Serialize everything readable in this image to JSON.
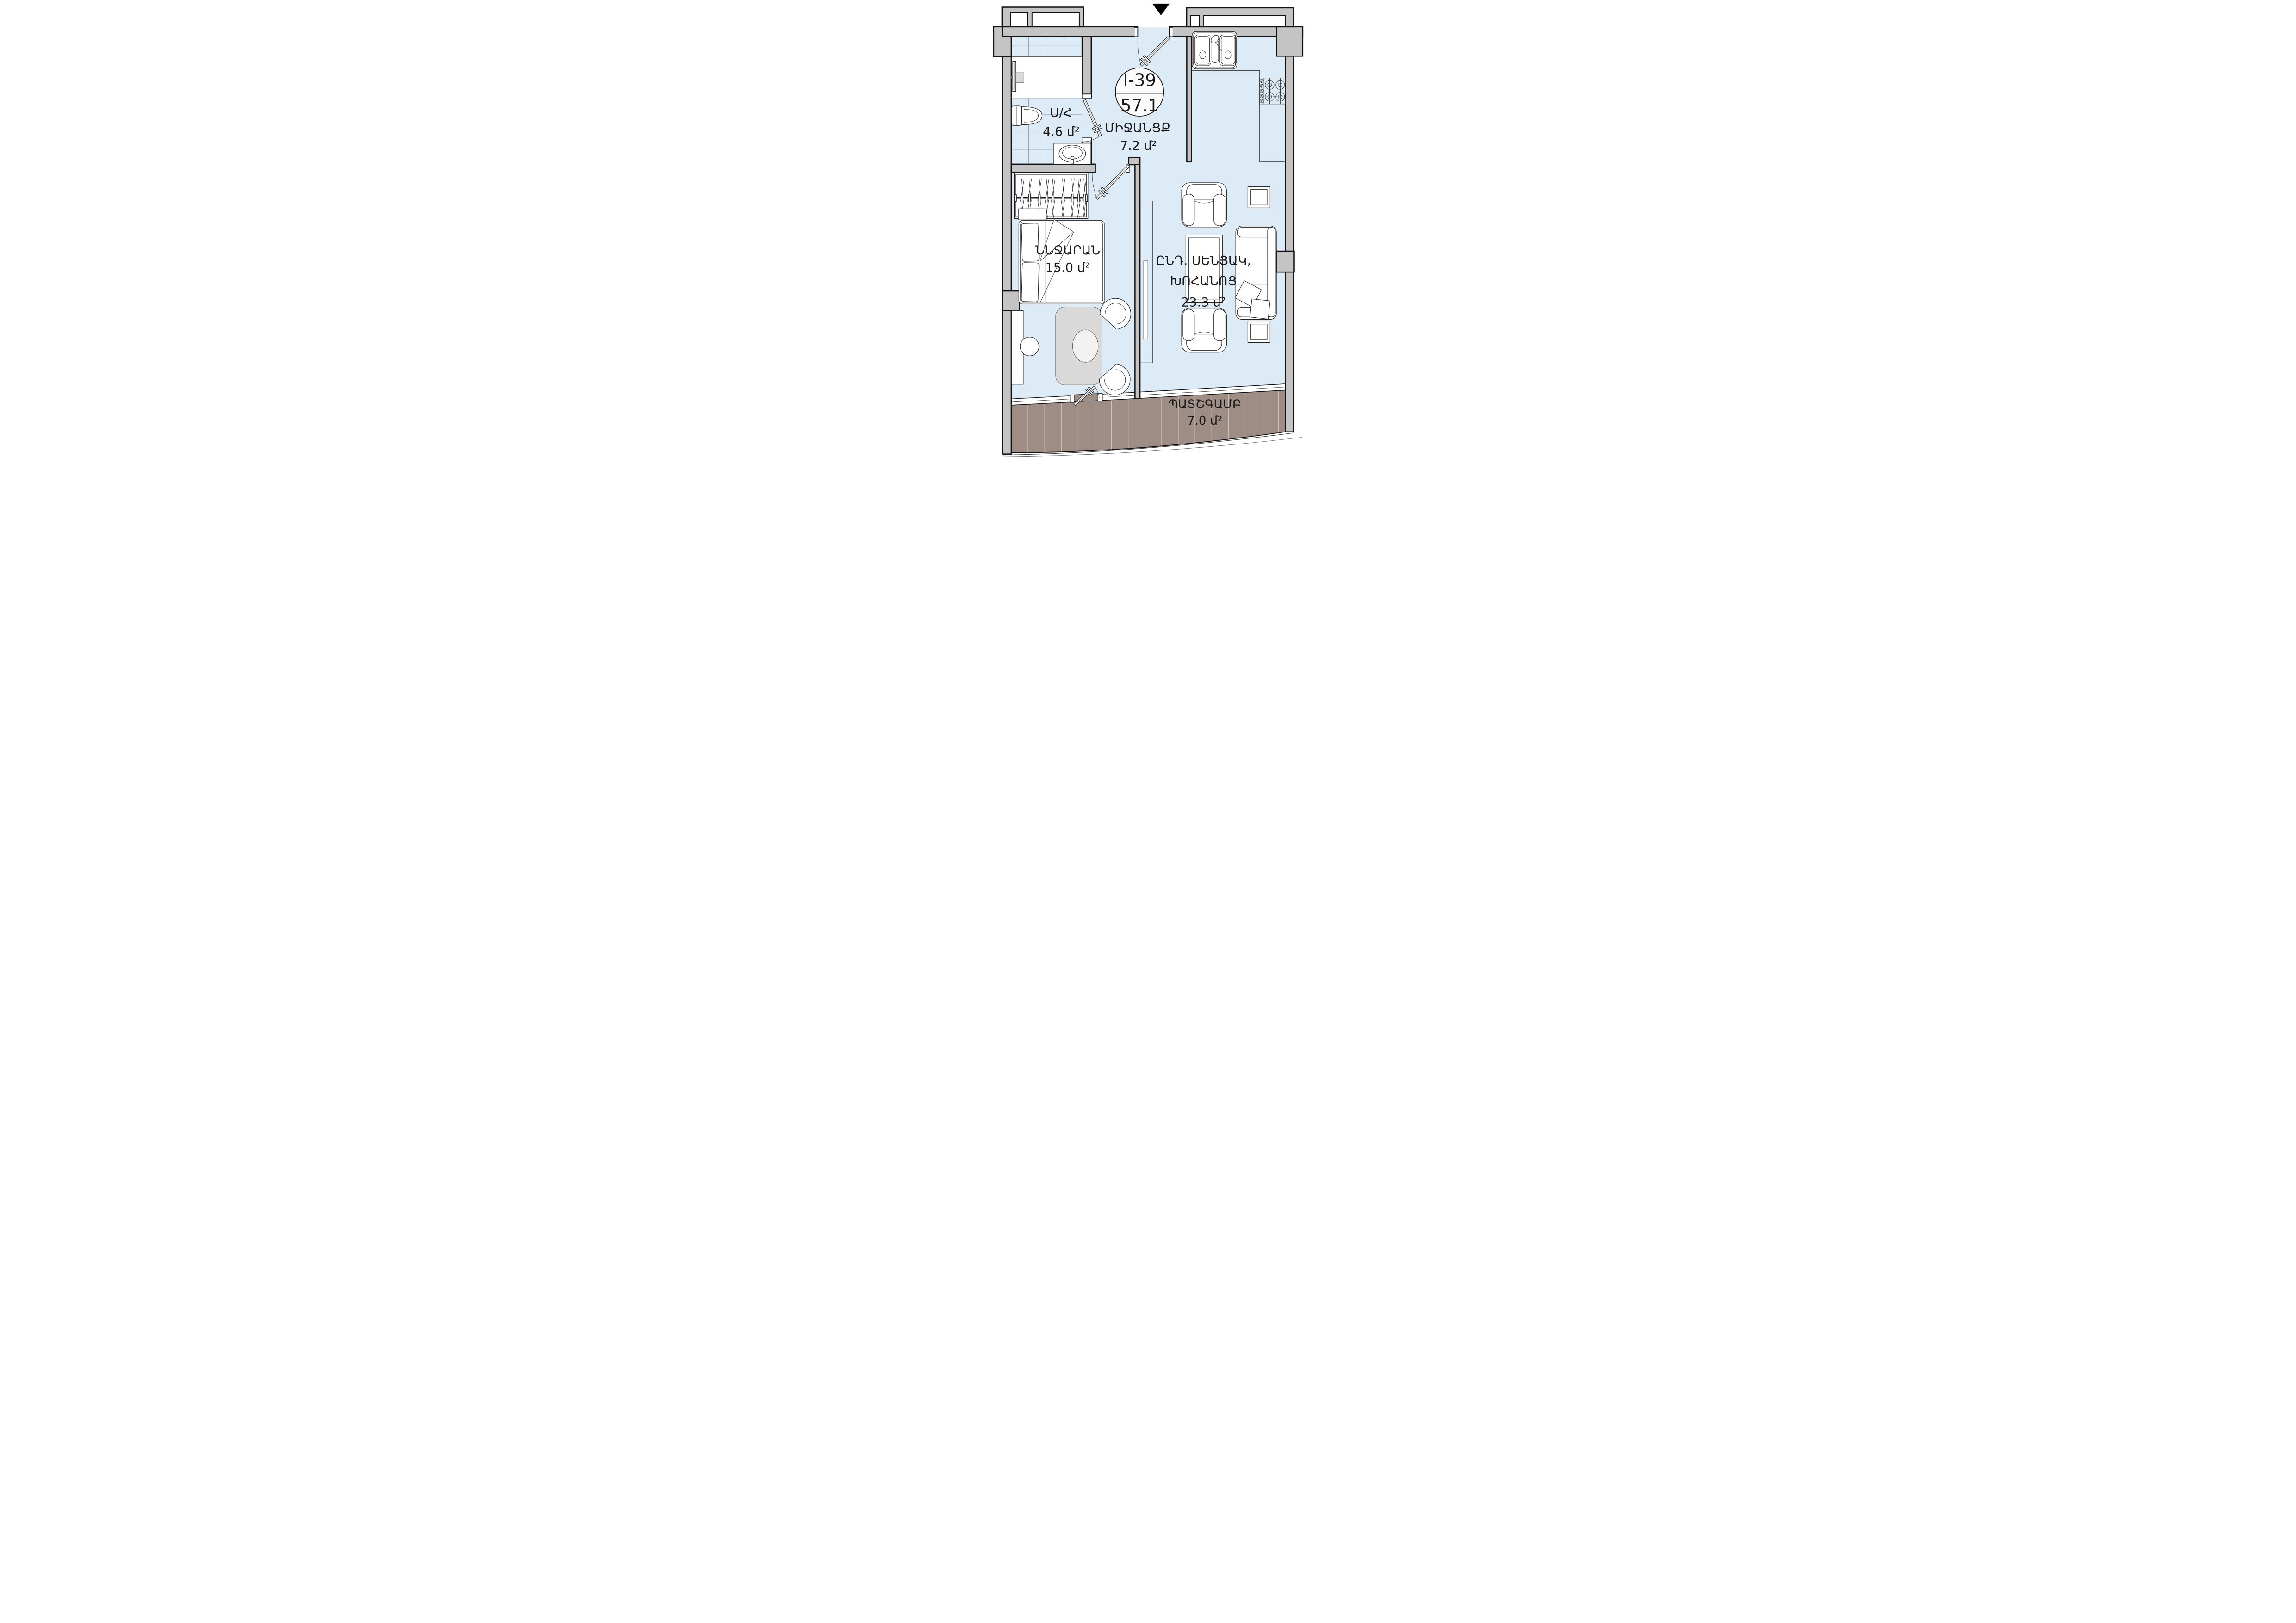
{
  "unit_badge": {
    "code": "I-39",
    "area": "57.1"
  },
  "rooms": {
    "bathroom": {
      "name": "Ս/Հ",
      "area": "4.6 մ²"
    },
    "hallway": {
      "name": "ՄԻՋԱՆՑՔ",
      "area": "7.2 մ²"
    },
    "bedroom": {
      "name": "ՆՆՋԱՐԱՆ",
      "area": "15.0 մ²"
    },
    "living_kitchen": {
      "name_line1": "ԸՆԴ. ՍԵՆՅԱԿ,",
      "name_line2": "ԽՈՀԱՆՈՑ",
      "area": "23.3 մ²"
    },
    "balcony": {
      "name": "ՊԱՏՇԳԱՄԲ",
      "area": "7.0 մ²"
    }
  },
  "colors": {
    "floor": "#dcebf5",
    "wall": "#c4c4c4",
    "balcony_deck": "#9d8d84",
    "outline": "#111111",
    "furniture_gray": "#d9d9d9",
    "tile_line": "#5f7484"
  }
}
